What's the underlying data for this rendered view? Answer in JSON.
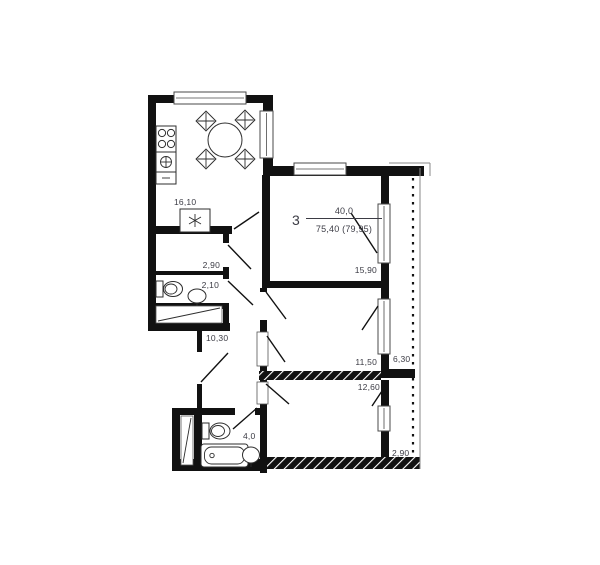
{
  "plan": {
    "apartment_label": {
      "rooms_count": "3",
      "living_area": "40,0",
      "total_area": "75,40 (79,95)"
    },
    "rooms": [
      {
        "id": "kitchen",
        "area": "16,10"
      },
      {
        "id": "storage",
        "area": "2,90"
      },
      {
        "id": "wc",
        "area": "2,10"
      },
      {
        "id": "hallway",
        "area": "10,30"
      },
      {
        "id": "bathroom",
        "area": "4,0"
      },
      {
        "id": "living-room",
        "area": "15,90"
      },
      {
        "id": "bedroom-middle",
        "area": "11,50"
      },
      {
        "id": "bedroom-bottom",
        "area": "12,60"
      },
      {
        "id": "balcony-right",
        "area": "6,30"
      },
      {
        "id": "balcony-bottom",
        "area": "2,90"
      }
    ],
    "colors": {
      "wall": "#111111",
      "text": "#3b3b44",
      "frame": "#4a4a4a",
      "background": "#ffffff"
    }
  }
}
